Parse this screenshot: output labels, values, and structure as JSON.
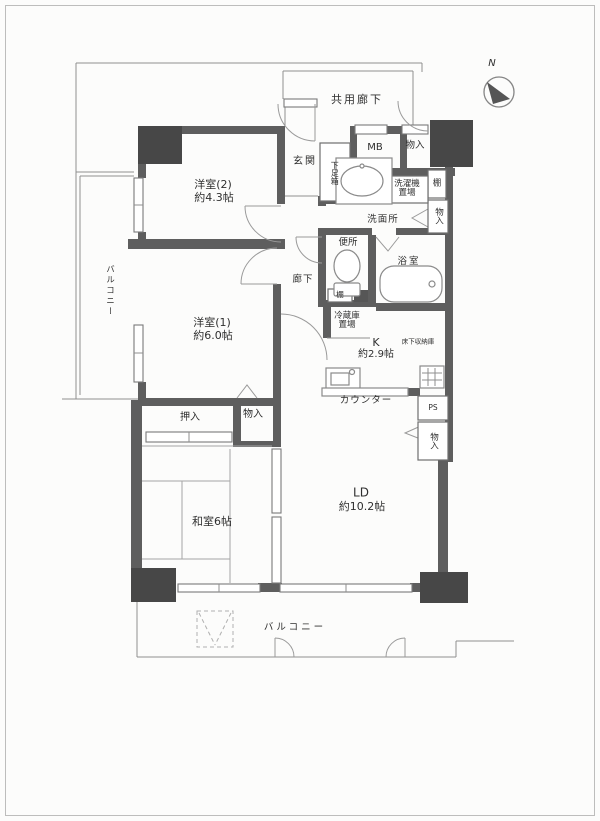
{
  "compass": {
    "n": "N"
  },
  "corridor": {
    "label": "共用廊下"
  },
  "rooms": {
    "western2_name": "洋室(2)",
    "western2_size": "約4.3帖",
    "western1_name": "洋室(1)",
    "western1_size": "約6.0帖",
    "japanese_room": "和室6帖",
    "ld_name": "LD",
    "ld_size": "約10.2帖",
    "kitchen_name": "K",
    "kitchen_size": "約2.9帖",
    "underfloor_storage": "床下収納庫"
  },
  "features": {
    "entrance": "玄関",
    "shoe_box": "下足箱",
    "meter_box": "MB",
    "closet_top": "物入",
    "washer_line1": "洗濯機",
    "washer_line2": "置場",
    "shelf_top": "棚",
    "washroom": "洗面所",
    "closet_washroom": "物入",
    "toilet": "便所",
    "bathroom": "浴室",
    "hallway": "廊下",
    "shelf_toilet": "棚",
    "fridge_line1": "冷蔵庫",
    "fridge_line2": "置場",
    "counter": "カウンター",
    "pipe_space": "PS",
    "closet_ld": "物入",
    "oshiire": "押入",
    "closet_mid": "物入",
    "balcony_left": "バルコニー",
    "balcony_bottom": "バルコニー"
  },
  "colors": {
    "wall": "#5e5e5e",
    "column": "#474747",
    "thin_line": "#8f8f8f",
    "text": "#2f2f2f",
    "paper": "#fcfcfb"
  }
}
